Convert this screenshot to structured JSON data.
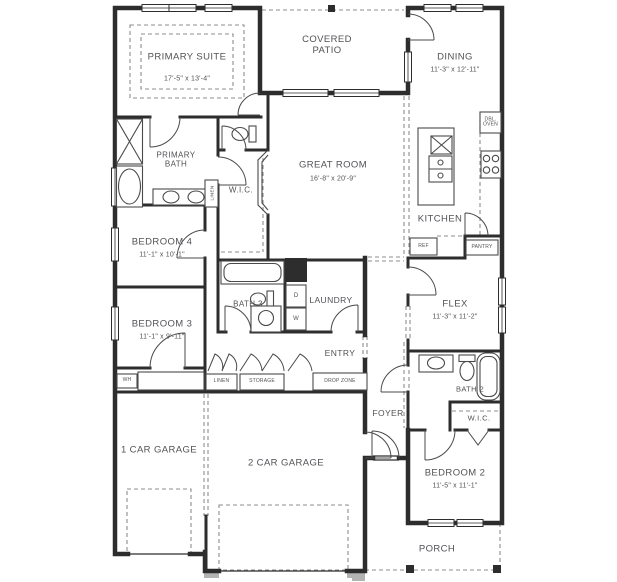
{
  "plan": {
    "rooms": {
      "primary_suite": {
        "name": "PRIMARY SUITE",
        "dims": "17'-5\" x 13'-4\""
      },
      "covered_patio": {
        "name": "COVERED PATIO"
      },
      "dining": {
        "name": "DINING",
        "dims": "11'-3\" x 12'-11\""
      },
      "great_room": {
        "name": "GREAT ROOM",
        "dims": "16'-8\" x 20'-9\""
      },
      "primary_bath": {
        "name": "PRIMARY BATH"
      },
      "wic_primary": {
        "name": "W.I.C."
      },
      "kitchen": {
        "name": "KITCHEN"
      },
      "bedroom_4": {
        "name": "BEDROOM 4",
        "dims": "11'-1\" x 10'-1\""
      },
      "bedroom_3": {
        "name": "BEDROOM 3",
        "dims": "11'-1\" x 9'-11\""
      },
      "bath_3": {
        "name": "BATH 3"
      },
      "laundry": {
        "name": "LAUNDRY"
      },
      "entry": {
        "name": "ENTRY"
      },
      "flex": {
        "name": "FLEX",
        "dims": "11'-3\" x 11'-2\""
      },
      "bath_2": {
        "name": "BATH 2"
      },
      "wic_2": {
        "name": "W.I.C."
      },
      "foyer": {
        "name": "FOYER"
      },
      "bedroom_2": {
        "name": "BEDROOM 2",
        "dims": "11'-5\" x 11'-1\""
      },
      "porch": {
        "name": "PORCH"
      },
      "garage_1": {
        "name": "1 CAR GARAGE"
      },
      "garage_2": {
        "name": "2 CAR GARAGE"
      }
    },
    "callouts": {
      "dbl_oven": "DBL. OVEN",
      "ref": "REF",
      "pantry": "PANTRY",
      "linen_primary": "LINEN",
      "linen_hall": "LINEN",
      "storage": "STORAGE",
      "drop_zone": "DROP ZONE",
      "water_heater": "WH",
      "dryer": "D",
      "washer": "W"
    },
    "colors": {
      "wall": "#2d2d2d",
      "text": "#525257",
      "background": "#ffffff"
    }
  }
}
